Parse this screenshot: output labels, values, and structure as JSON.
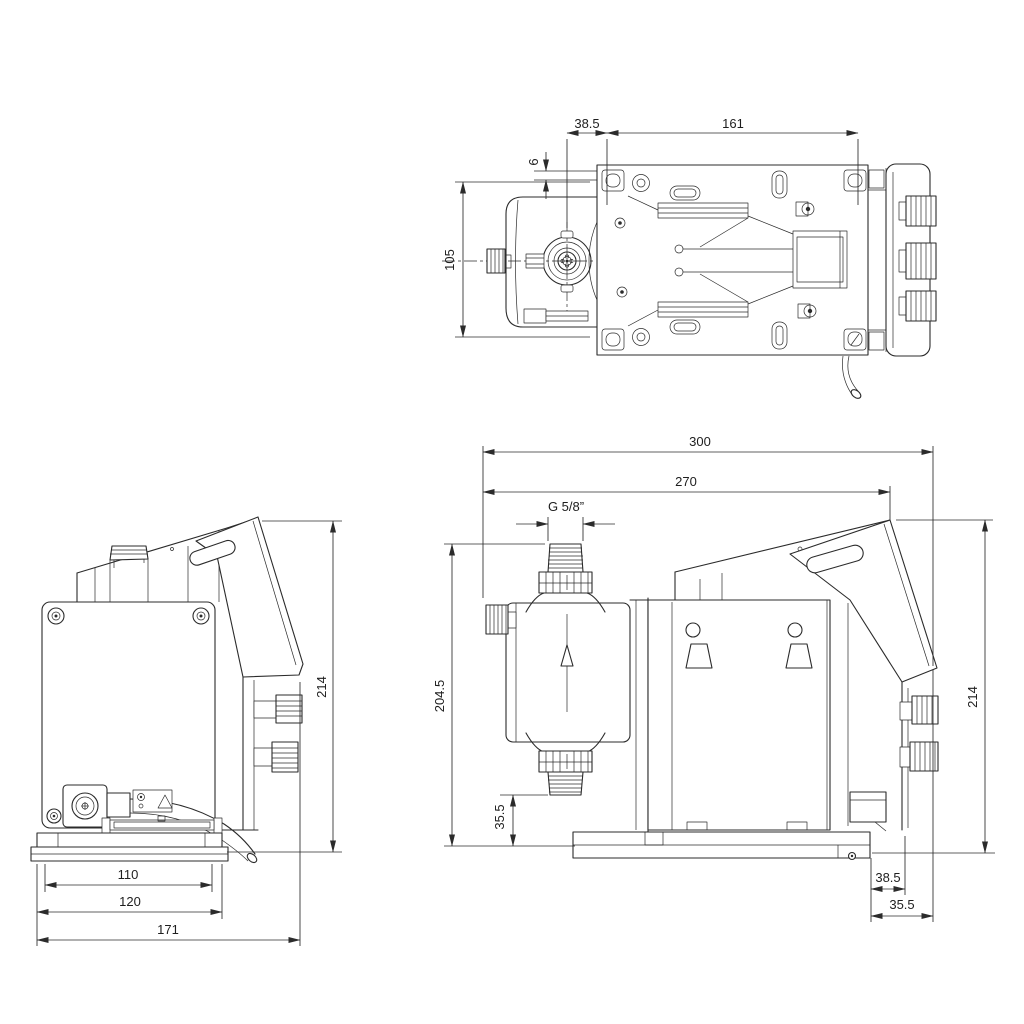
{
  "drawing": {
    "type": "pump dimensional drawing",
    "units": "mm",
    "line_color": "#2b2b2b",
    "background": "#ffffff",
    "views": {
      "top_view": {
        "name": "Top view",
        "dims": {
          "offset_left": "38.5",
          "mount_hole_spacing": "161",
          "edge_offset": "6",
          "head_width": "105"
        }
      },
      "rear_view": {
        "name": "Rear view",
        "dims": {
          "height": "214",
          "plate_width": "110",
          "base_width": "120",
          "overall_depth": "171"
        }
      },
      "side_view": {
        "name": "Side view",
        "dims": {
          "overall_length": "300",
          "length_to_panel": "270",
          "thread": "G 5/8”",
          "head_top_height": "204.5",
          "suction_height": "35.5",
          "height": "214",
          "base_offset": "38.5",
          "panel_overhang": "35.5"
        }
      }
    }
  }
}
